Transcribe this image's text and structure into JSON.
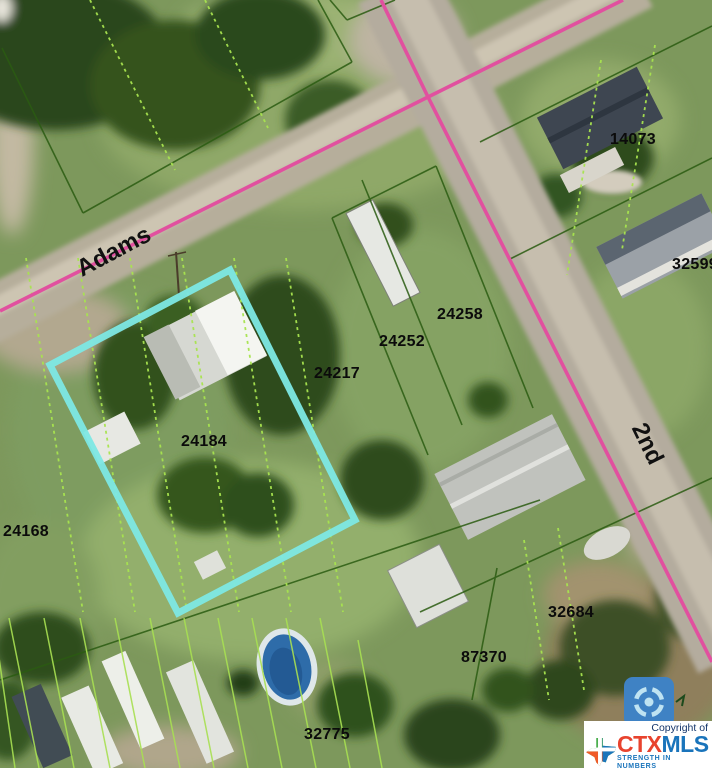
{
  "map": {
    "description": "aerial parcel map",
    "parcel_labels": [
      "14073",
      "32599",
      "24258",
      "24252",
      "24217",
      "24184",
      "24168",
      "32684",
      "87370",
      "32775"
    ],
    "street_labels": {
      "adams": "Adams",
      "second": "2nd"
    },
    "highlighted_parcel_id": "24184",
    "colors": {
      "highlight_parcel": "#7de8e4",
      "road_centerline": "#e1509f",
      "parcel_boundary": "#2b5c12",
      "lot_line_dotted": "#a8e44f"
    }
  },
  "controls": {
    "locate_icon": "compass-locate-icon"
  },
  "branding": {
    "copyright": "Copyright of",
    "logo_ctx": "CTX",
    "logo_mls": "MLS",
    "tagline": "STRENGTH IN NUMBERS"
  }
}
